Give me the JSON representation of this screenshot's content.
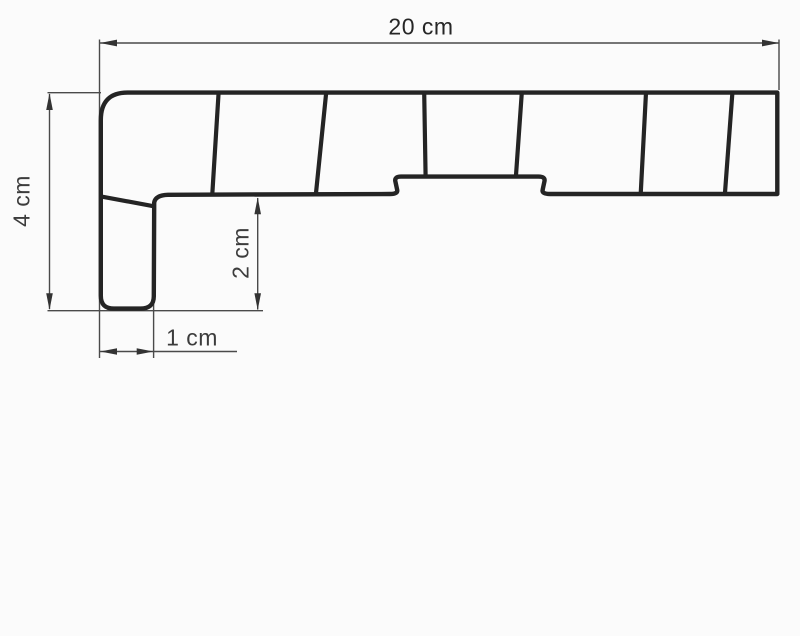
{
  "drawing": {
    "kind": "windowsill-profile-cross-section",
    "dimensions": {
      "total_width": {
        "label": "20 cm",
        "value": 20,
        "unit": "cm"
      },
      "total_height": {
        "label": "4 cm",
        "value": 4,
        "unit": "cm"
      },
      "front_height": {
        "label": "2 cm",
        "value": 2,
        "unit": "cm"
      },
      "front_width": {
        "label": "1 cm",
        "value": 1,
        "unit": "cm"
      }
    }
  },
  "colors": {
    "outline": "#242424",
    "web_line": "#242424",
    "dimension_line": "#4a4a4a",
    "arrow": "#333333",
    "label_text": "#3c3c3c",
    "background": "#fbfbfb"
  }
}
